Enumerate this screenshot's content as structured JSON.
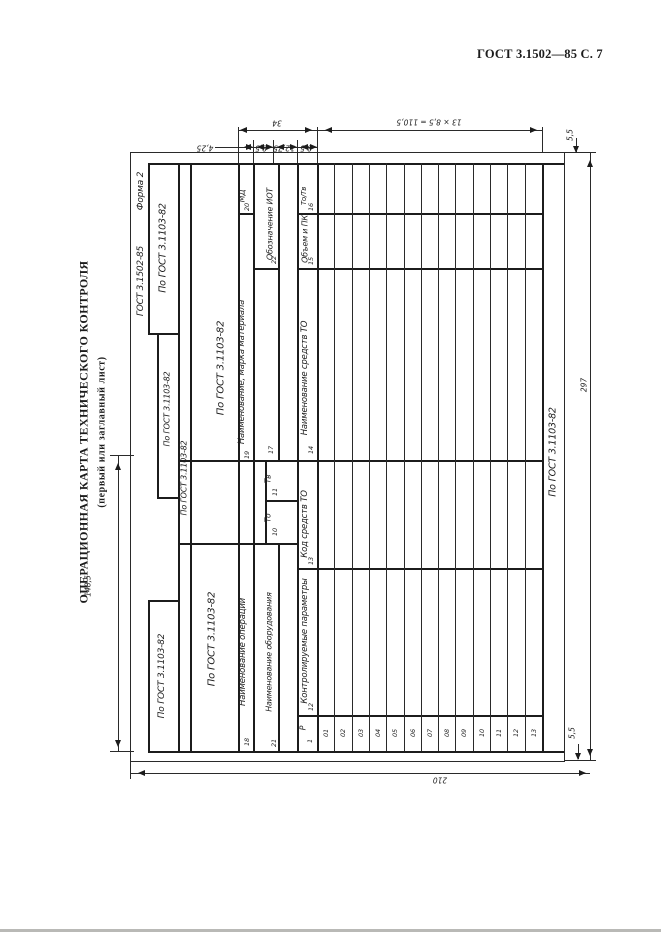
{
  "page": {
    "header_right": "ГОСТ 3.1502—85 С. 7"
  },
  "title": {
    "main": "ОПЕРАЦИОННАЯ КАРТА ТЕХНИЧЕСКОГО КОНТРОЛЯ",
    "subtitle": "(первый или заглавный лист)"
  },
  "form": {
    "designation": "ГОСТ 3.1502-85",
    "form_number": "Форма 2",
    "gost_ref": "По ГОСТ 3.1103-82",
    "cells": {
      "c10": {
        "label": "То",
        "num": "10"
      },
      "c11": {
        "label": "Тв",
        "num": "11"
      },
      "c12": {
        "label": "Контролируемые параметры",
        "num": "12"
      },
      "c13": {
        "label": "Код средств ТО",
        "num": "13"
      },
      "c14": {
        "label": "Наименование средств ТО",
        "num": "14"
      },
      "c15": {
        "label": "Объем и ПК",
        "num": "15"
      },
      "c16": {
        "label": "То/Тв",
        "num": "16"
      },
      "c17": {
        "num": "17"
      },
      "c18": {
        "label": "Наименование операции",
        "num": "18"
      },
      "c19": {
        "label": "Наименование, марка материала",
        "num": "19"
      },
      "c20": {
        "label": "МД",
        "num": "20"
      },
      "c21": {
        "label": "Наименование оборудования",
        "num": "21"
      },
      "c22": {
        "label": "Обозначение ИОТ",
        "num": "22"
      }
    },
    "row_col": {
      "header": "Р",
      "num": "1",
      "rows": [
        "01",
        "02",
        "03",
        "04",
        "05",
        "06",
        "07",
        "08",
        "09",
        "10",
        "11",
        "12",
        "13"
      ]
    }
  },
  "dims": {
    "w425": "4,25",
    "w85a": "8,5",
    "w1275": "12,75",
    "w85b": "8,5",
    "w34": "34",
    "grid": "13 × 8,5 = 110,5",
    "margin_top": "5,5",
    "margin_bottom": "5,5",
    "height": "297",
    "width": "210",
    "half": "148,5"
  }
}
